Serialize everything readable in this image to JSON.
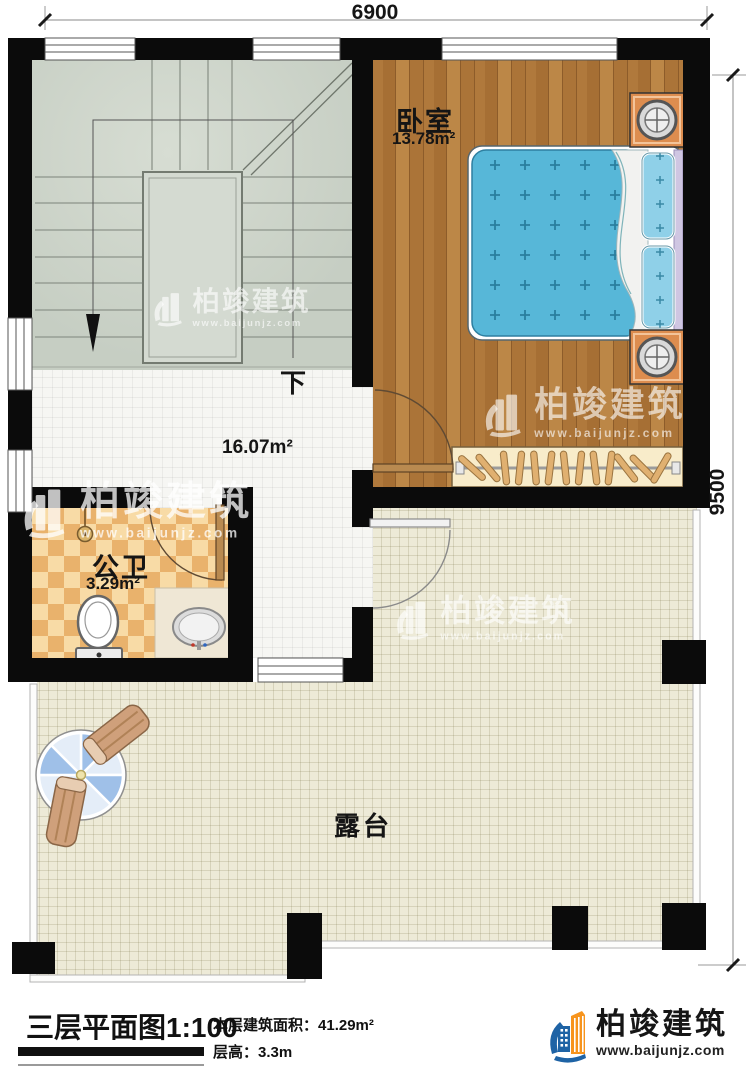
{
  "dimensions": {
    "top": "6900",
    "right": "9500"
  },
  "rooms": {
    "bedroom": {
      "name": "卧室",
      "area": "13.78m²"
    },
    "hall": {
      "area": "16.07m²"
    },
    "bathroom": {
      "name": "公卫",
      "area": "3.29m²"
    },
    "terrace": {
      "name": "露台"
    },
    "stairs": {
      "down_label": "下"
    }
  },
  "footer": {
    "title": "三层平面图",
    "scale": "1:100",
    "area_label": "本层建筑面积：",
    "area_value": "41.29m²",
    "height_label": "层高：",
    "height_value": "3.3m"
  },
  "brand": {
    "name": "柏竣建筑",
    "url": "www.baijunjz.com"
  },
  "watermark": {
    "name": "柏竣建筑",
    "url": "www.baijunjz.com"
  },
  "colors": {
    "wall": "#0b0b0b",
    "bed": "#57b7d8",
    "pillow": "#8fd0e8",
    "nightstand": "#dd8d4f",
    "wood": "#b0793c",
    "bath_checker_dark": "#e9b26c",
    "bath_checker_light": "#f8dba6",
    "stair_floor": "#cbd2c8",
    "terrace_floor": "#edead7",
    "brand_blue": "#1e63a5",
    "brand_orange": "#f7941d"
  }
}
